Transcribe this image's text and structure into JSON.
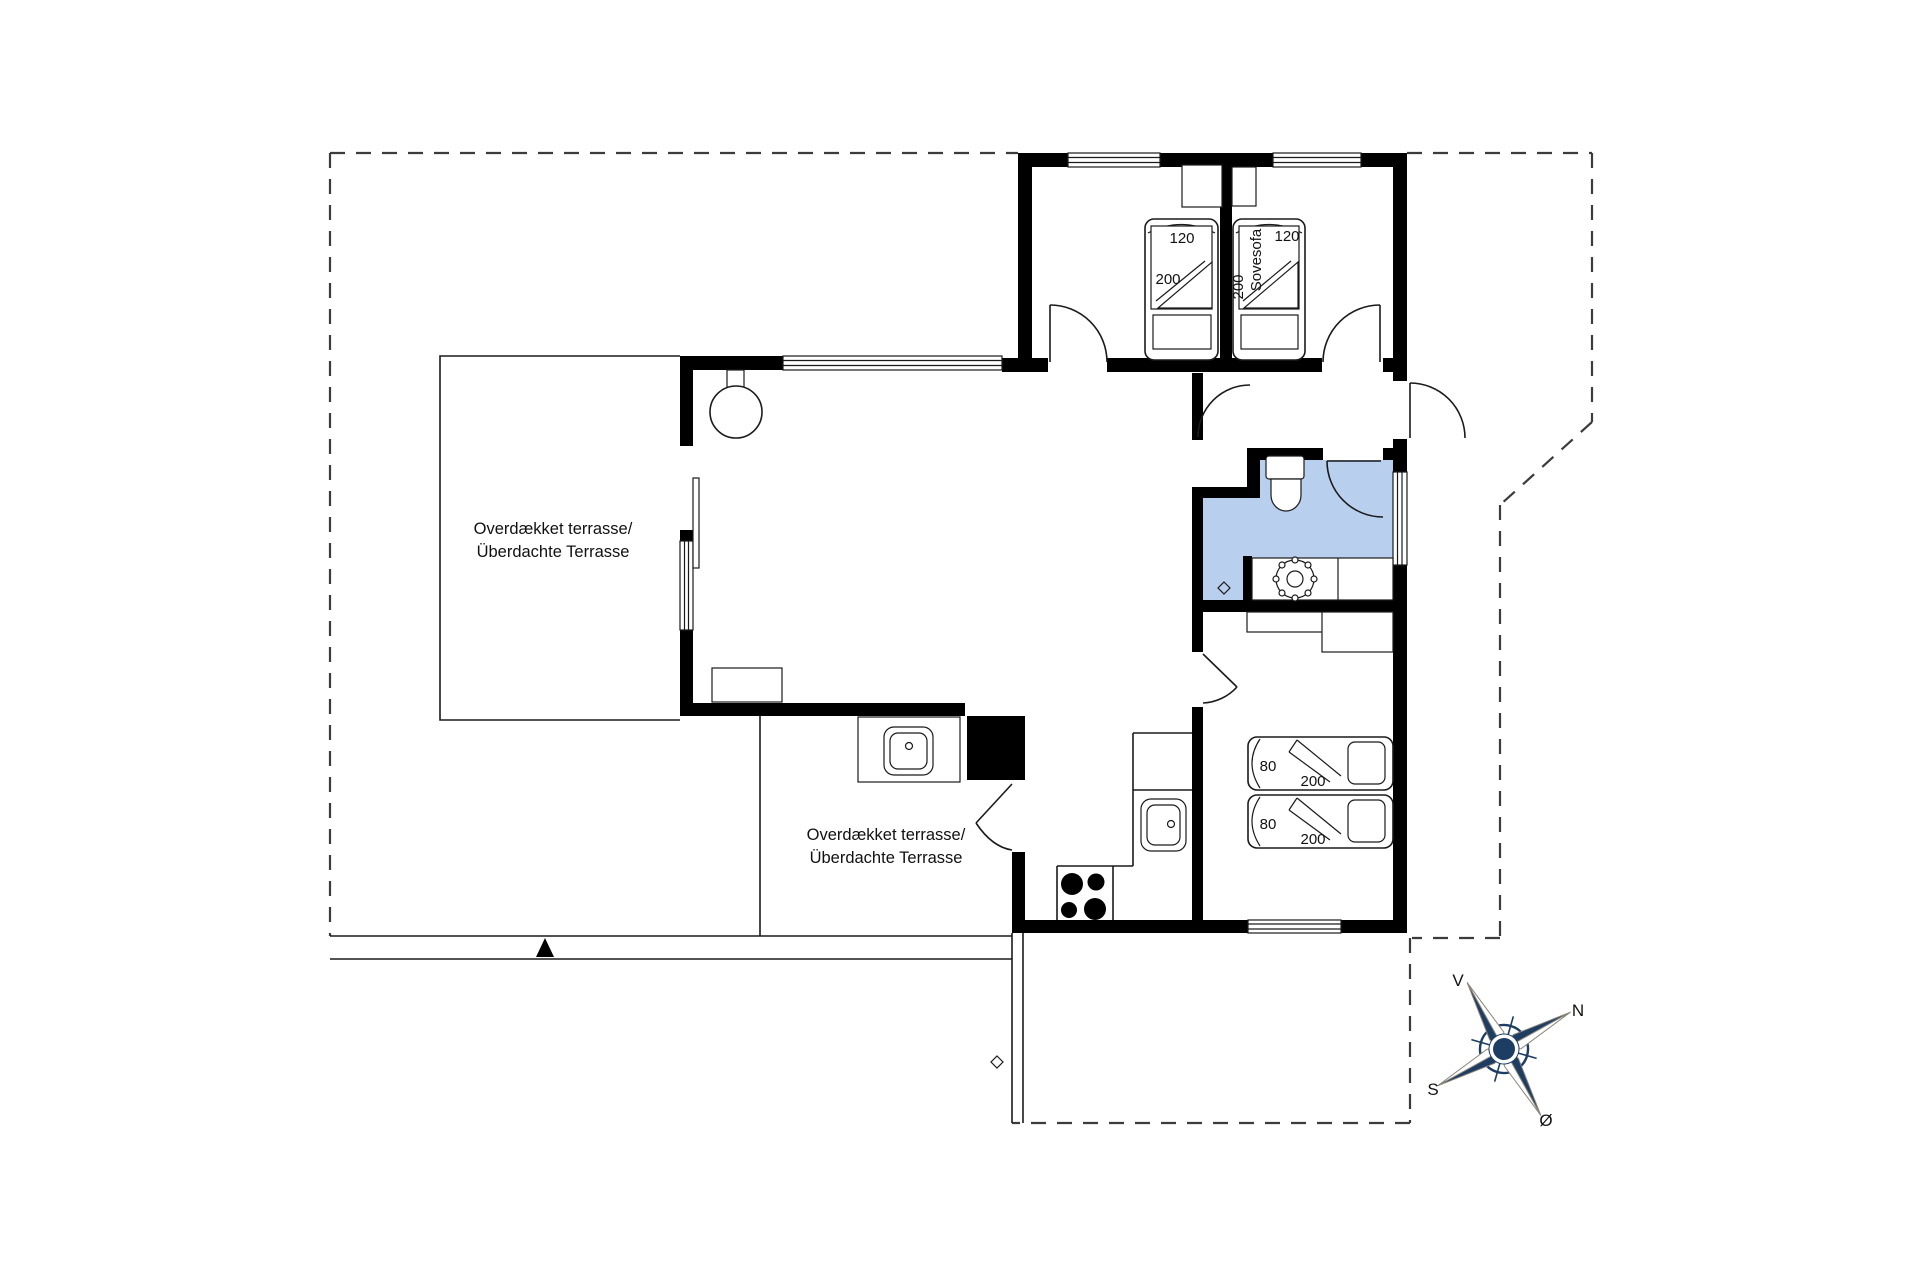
{
  "terraces": {
    "upper": {
      "line1": "Overdækket terrasse/",
      "line2": "Überdachte Terrasse"
    },
    "lower": {
      "line1": "Overdækket terrasse/",
      "line2": "Überdachte Terrasse"
    }
  },
  "beds": {
    "top_left": {
      "width": "120",
      "length": "200"
    },
    "top_right": {
      "width": "120",
      "length": "200",
      "type": "Sovesofa"
    },
    "right_bed1": {
      "width": "80",
      "length": "200"
    },
    "right_bed2": {
      "width": "80",
      "length": "200"
    }
  },
  "compass": {
    "v": "V",
    "n": "N",
    "s": "S",
    "o": "Ø"
  },
  "colors": {
    "wall": "#000000",
    "bathroom_fill": "#b9cfee",
    "compass_navy": "#1d3d63",
    "line": "#1a1a1a",
    "boundary_dash": "#3c3c3c"
  }
}
